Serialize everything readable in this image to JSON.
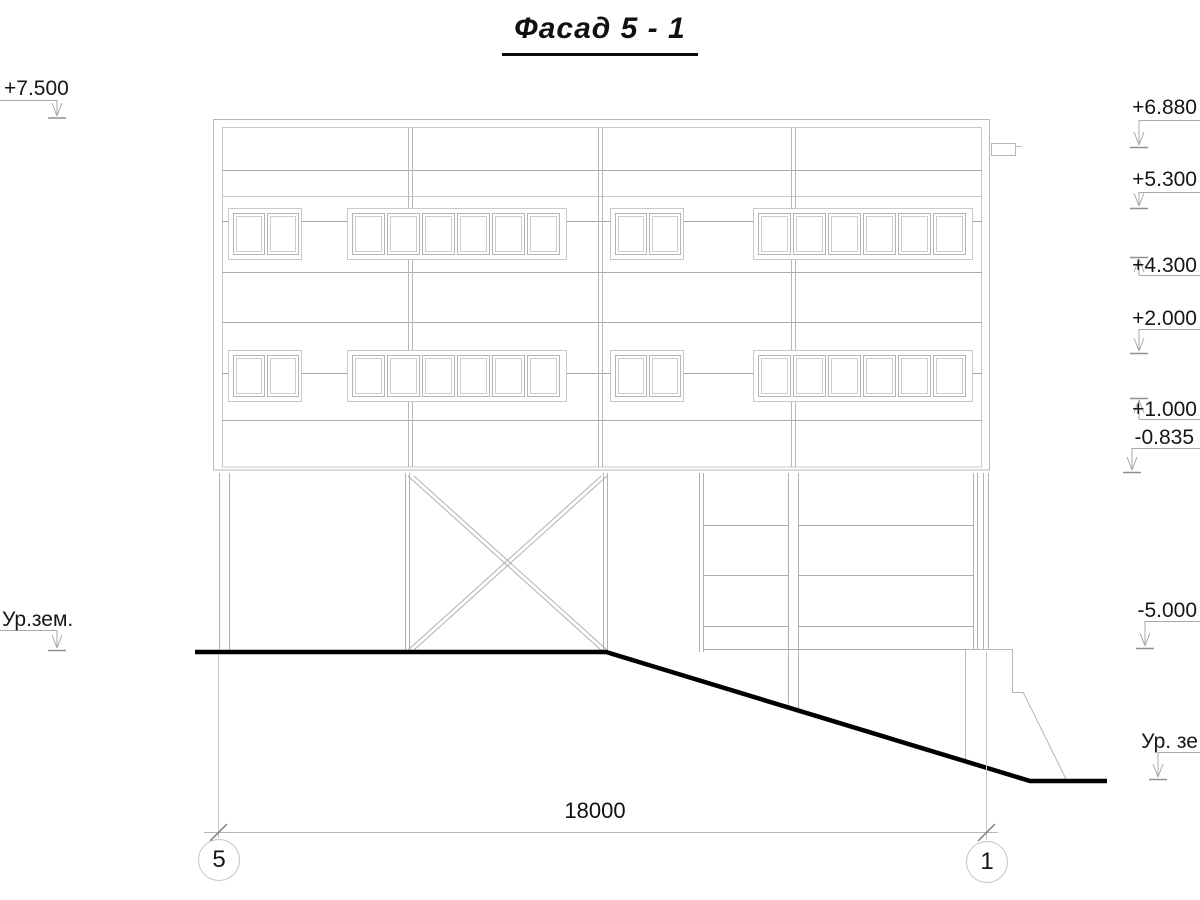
{
  "title": "Фасад 5 - 1",
  "dimension_label": "18000",
  "axis_bubbles": {
    "left": "5",
    "right": "1"
  },
  "elevation_marks": {
    "left_top": "+7.500",
    "ground_left": "Ур.зем.",
    "right": [
      "+6.880",
      "+5.300",
      "+4.300",
      "+2.000",
      "+1.000",
      "-0.835",
      "-5.000"
    ],
    "ground_right": "Ур. зе"
  },
  "colors": {
    "line_light": "#c6cacc",
    "line_mid": "#b3b8ba",
    "line_dark": "#9fa5a8",
    "ground_line": "#000000",
    "text": "#161616"
  }
}
